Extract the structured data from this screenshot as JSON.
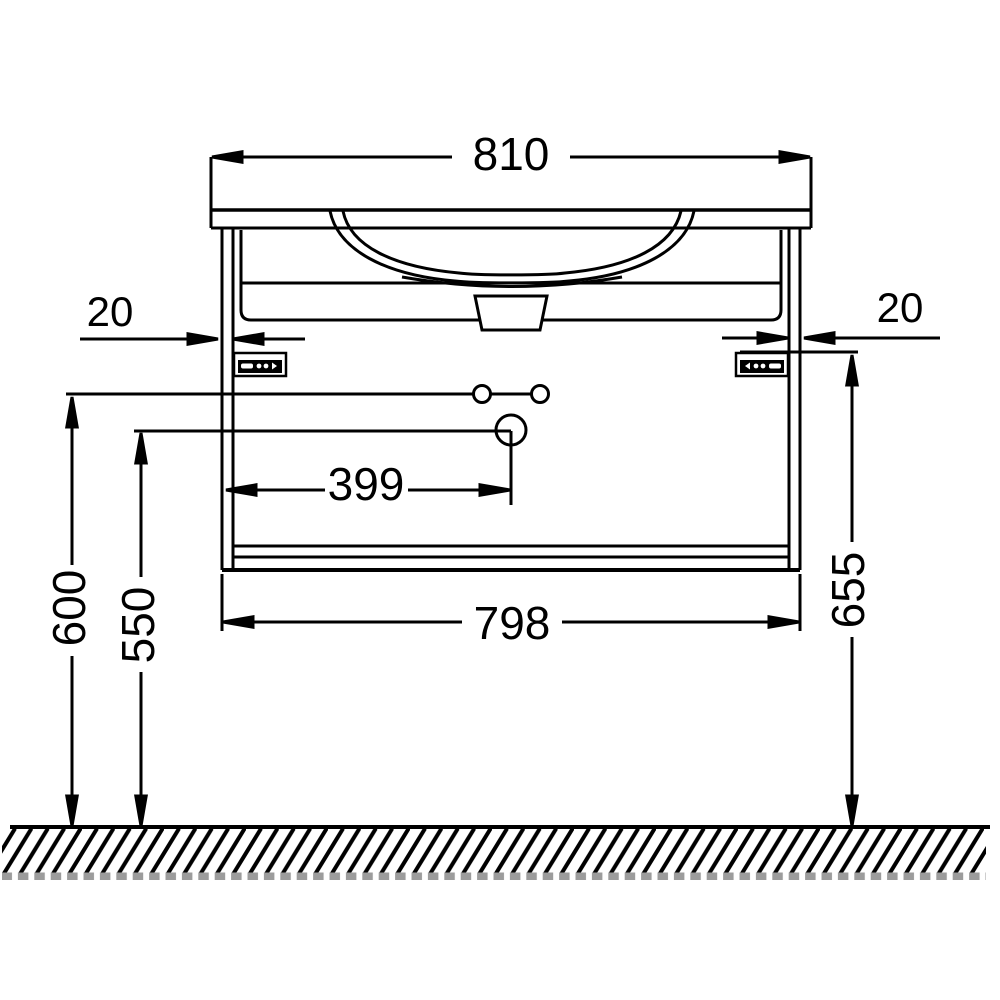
{
  "meta": {
    "description": "Technical dimension drawing (front elevation) of a wall-hung bathroom vanity unit with inset washbasin, mounting rails and floor reference line",
    "background_color": "#ffffff",
    "line_color": "#000000",
    "units": "mm"
  },
  "dimensions": {
    "overall_width": "810",
    "wall_rail_left": "20",
    "wall_rail_right": "20",
    "drain_offset_from_left": "399",
    "carcass_width": "798",
    "holes_height_from_floor": "600",
    "drain_height_from_floor": "550",
    "rail_height_from_floor": "655"
  }
}
